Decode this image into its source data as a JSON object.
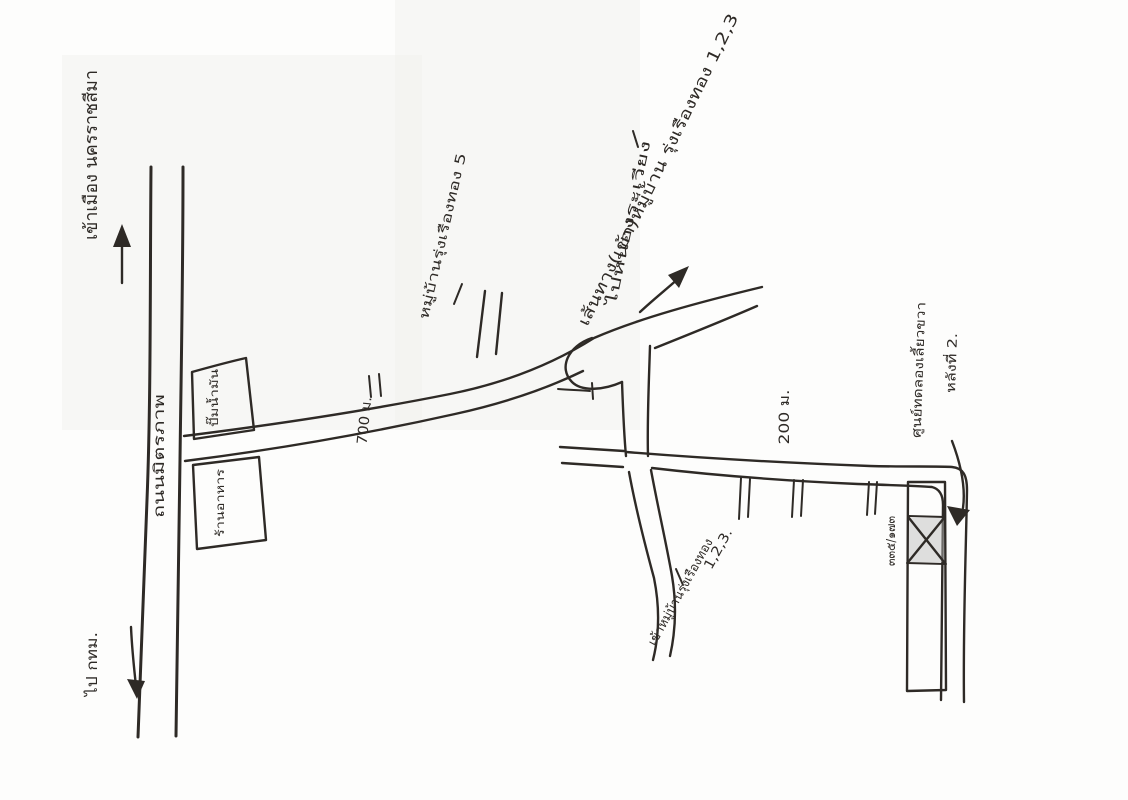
{
  "colors": {
    "ink": "#2e2a26",
    "paper": "#fdfdfc",
    "block_shading": "#b9b9b9"
  },
  "labels": {
    "to_city": "เข้าเมือง นครราชสีมา",
    "main_road": "ถนนมิตรภาพ",
    "to_bangkok": "ไป กทม.",
    "building_north": "ปั๊มน้ำมัน",
    "building_south": "ร้านอาหาร",
    "distance_700": "700 ม.",
    "distance_200": "200 ม.",
    "village_5": "หมู่บ้านรุ่งเรืองทอง 5",
    "route_title": "เส้นทาง(เข้า)หมู่บ้าน รุ่งเรืองทอง 1,2,3",
    "to_northeast": "ไปหนองระเวียง",
    "village_123": "เข้าหมู่บ้านรุ่งเรืองทอง",
    "village_123_numbers": "1,2,3.",
    "destination_line1": "ศูนย์ทดลองเลี้ยวขวา",
    "destination_line2": "หลังที่ 2.",
    "house_number": "๓๓๕/๑๗๓"
  }
}
